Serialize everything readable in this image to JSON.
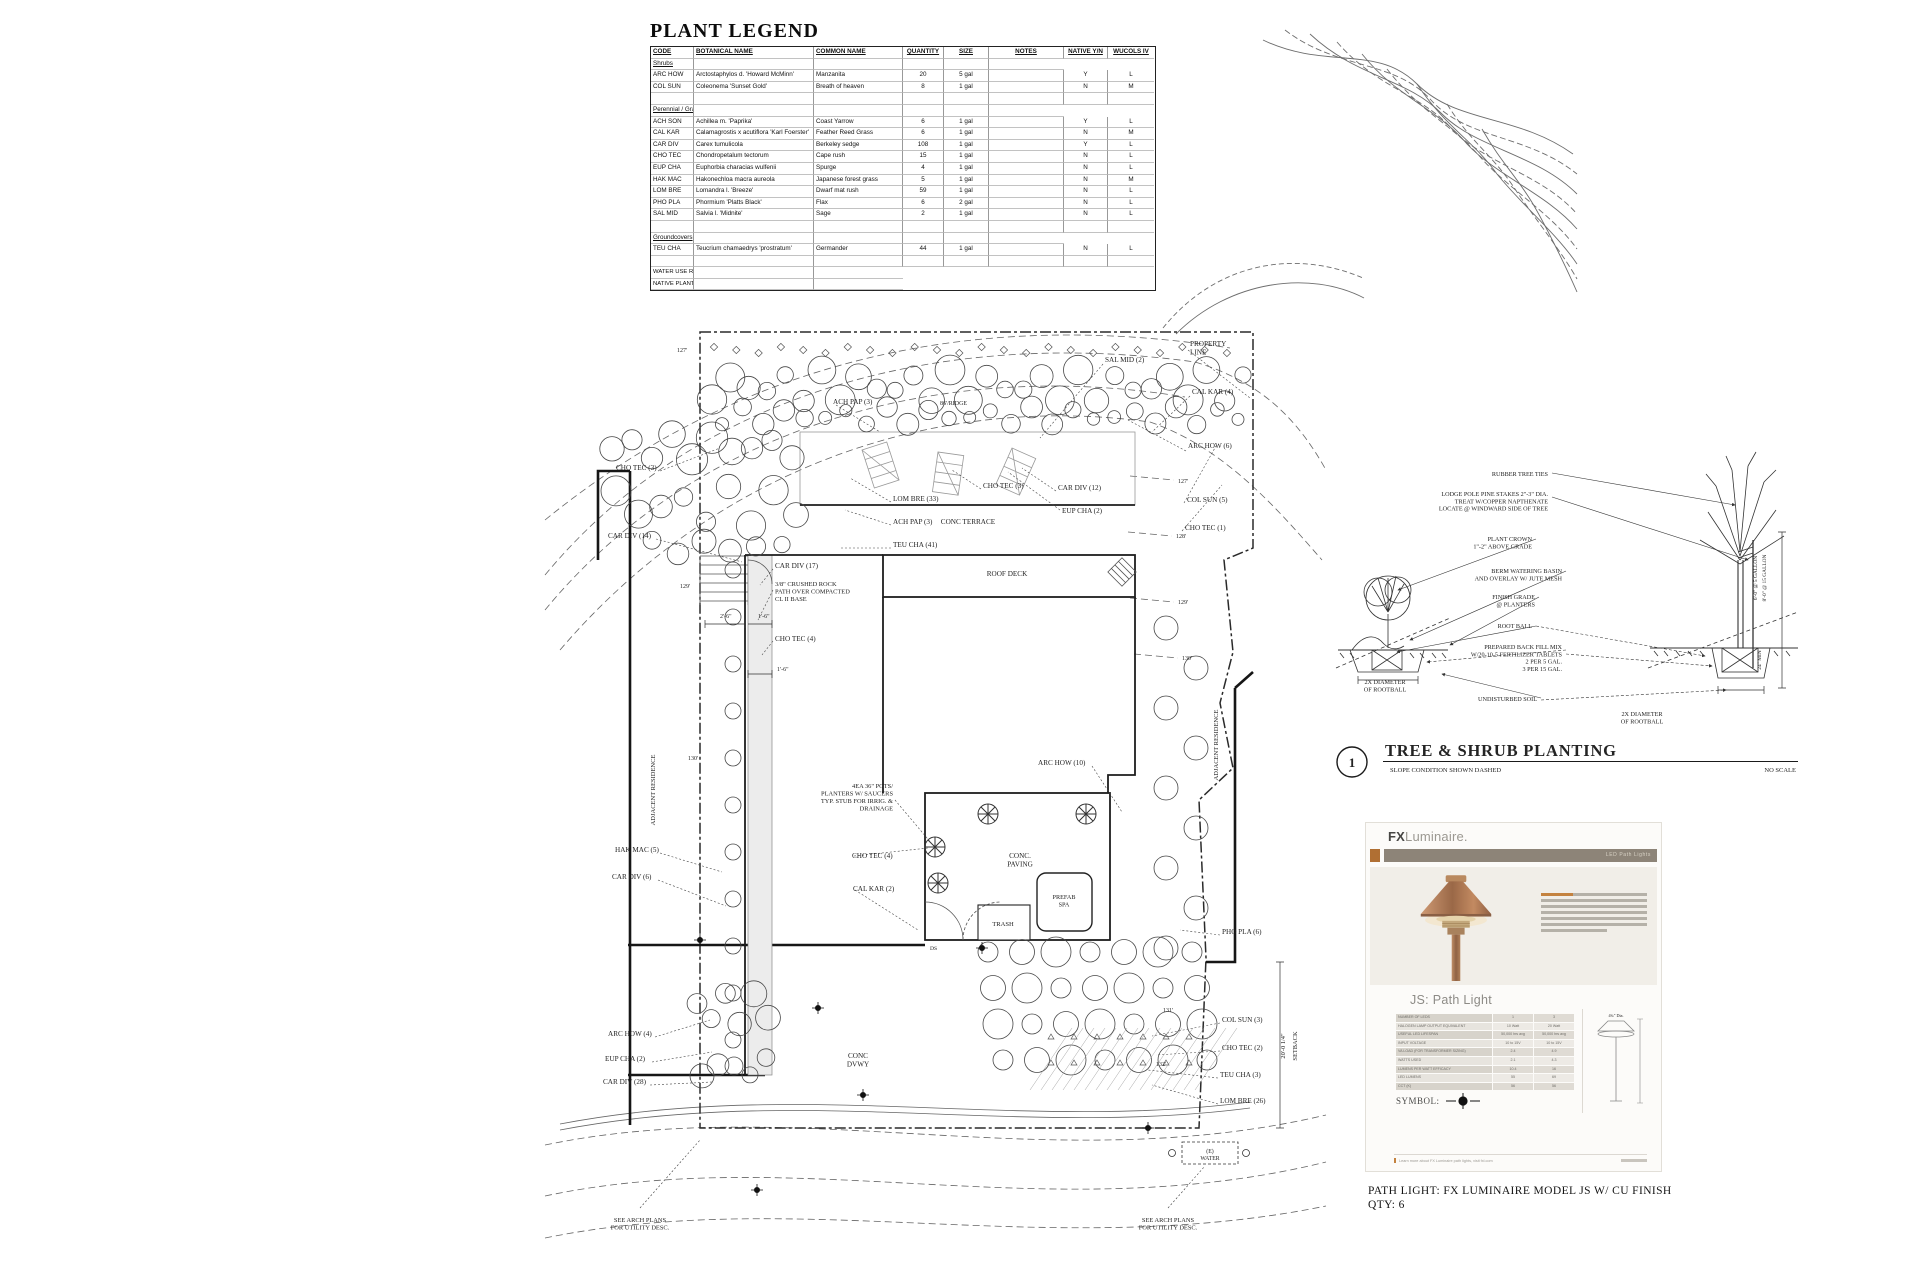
{
  "plant_legend": {
    "title": "PLANT LEGEND",
    "columns": [
      "CODE",
      "BOTANICAL NAME",
      "COMMON NAME",
      "QUANTITY",
      "SIZE",
      "NOTES",
      "NATIVE Y/N",
      "WUCOLS IV"
    ],
    "rows": [
      {
        "type": "section",
        "label": "Shrubs"
      },
      {
        "type": "item",
        "cells": [
          "ARC HOW",
          "Arctostaphylos d. 'Howard McMinn'",
          "Manzanita",
          "20",
          "5 gal",
          "",
          "Y",
          "L"
        ]
      },
      {
        "type": "item",
        "cells": [
          "COL SUN",
          "Coleonema 'Sunset Gold'",
          "Breath of heaven",
          "8",
          "1 gal",
          "",
          "N",
          "M"
        ]
      },
      {
        "type": "blank"
      },
      {
        "type": "section",
        "label": "Perennial / Grasses / Vines"
      },
      {
        "type": "item",
        "cells": [
          "ACH SON",
          "Achillea m. 'Paprika'",
          "Coast Yarrow",
          "6",
          "1 gal",
          "",
          "Y",
          "L"
        ]
      },
      {
        "type": "item",
        "cells": [
          "CAL KAR",
          "Calamagrostis x acutiflora 'Karl Foerster'",
          "Feather Reed Grass",
          "6",
          "1 gal",
          "",
          "N",
          "M"
        ]
      },
      {
        "type": "item",
        "cells": [
          "CAR DIV",
          "Carex tumulicola",
          "Berkeley sedge",
          "108",
          "1 gal",
          "",
          "Y",
          "L"
        ]
      },
      {
        "type": "item",
        "cells": [
          "CHO TEC",
          "Chondropetalum tectorum",
          "Cape rush",
          "15",
          "1 gal",
          "",
          "N",
          "L"
        ]
      },
      {
        "type": "item",
        "cells": [
          "EUP CHA",
          "Euphorbia characias wulfenii",
          "Spurge",
          "4",
          "1 gal",
          "",
          "N",
          "L"
        ]
      },
      {
        "type": "item",
        "cells": [
          "HAK MAC",
          "Hakonechloa macra aureola",
          "Japanese forest grass",
          "5",
          "1 gal",
          "",
          "N",
          "M"
        ]
      },
      {
        "type": "item",
        "cells": [
          "LOM BRE",
          "Lomandra l. 'Breeze'",
          "Dwarf mat rush",
          "59",
          "1 gal",
          "",
          "N",
          "L"
        ]
      },
      {
        "type": "item",
        "cells": [
          "PHO PLA",
          "Phormium 'Platts Black'",
          "Flax",
          "6",
          "2 gal",
          "",
          "N",
          "L"
        ]
      },
      {
        "type": "item",
        "cells": [
          "SAL MID",
          "Salvia l. 'Midnite'",
          "Sage",
          "2",
          "1 gal",
          "",
          "N",
          "L"
        ]
      },
      {
        "type": "blank"
      },
      {
        "type": "section",
        "label": "Groundcovers"
      },
      {
        "type": "item",
        "cells": [
          "TEU CHA",
          "Teucrium chamaedrys 'prostratum'",
          "Germander",
          "44",
          "1 gal",
          "",
          "N",
          "L"
        ]
      },
      {
        "type": "blank"
      }
    ],
    "notes": [
      "WATER USE RATINGS OBTAINED FROM THE \"WATER USE CLASSIFICATION OF LANDSCAPE SPECIES (WUCOLS)\" LIST.",
      "NATIVE PLANTS INFORMATION OBTAINED FROM THE 'STOPWASTE.ORG' LIST OF LOCAL NATIVE PLANTS & CALFLORA.ORG"
    ]
  },
  "site_plan": {
    "labels": [
      {
        "x": 833,
        "y": 404,
        "l": [
          "ACH PAP (3)"
        ]
      },
      {
        "x": 940,
        "y": 405,
        "s": 6,
        "l": [
          "86'/RIDGE"
        ]
      },
      {
        "x": 1105,
        "y": 362,
        "l": [
          "SAL MID (2)"
        ]
      },
      {
        "x": 1190,
        "y": 346,
        "l": [
          "PROPERTY",
          "LINE"
        ]
      },
      {
        "x": 1192,
        "y": 394,
        "l": [
          "CAL KAR (4)"
        ]
      },
      {
        "x": 1188,
        "y": 448,
        "l": [
          "ARC HOW (6)"
        ]
      },
      {
        "x": 1187,
        "y": 502,
        "l": [
          "COL SUN (5)"
        ]
      },
      {
        "x": 1185,
        "y": 530,
        "l": [
          "CHO TEC (1)"
        ]
      },
      {
        "x": 983,
        "y": 488,
        "l": [
          "CHO TEC (3)"
        ]
      },
      {
        "x": 1058,
        "y": 490,
        "l": [
          "CAR DIV (12)"
        ]
      },
      {
        "x": 1062,
        "y": 513,
        "l": [
          "EUP CHA (2)"
        ]
      },
      {
        "x": 893,
        "y": 501,
        "l": [
          "LOM BRE (33)"
        ]
      },
      {
        "x": 968,
        "y": 524,
        "a": "m",
        "l": [
          "CONC TERRACE"
        ]
      },
      {
        "x": 893,
        "y": 524,
        "l": [
          "ACH PAP (3)"
        ]
      },
      {
        "x": 893,
        "y": 547,
        "l": [
          "TEU CHA (41)"
        ]
      },
      {
        "x": 616,
        "y": 470,
        "l": [
          "CHO TEC (3)"
        ]
      },
      {
        "x": 608,
        "y": 538,
        "l": [
          "CAR DIV (14)"
        ]
      },
      {
        "x": 775,
        "y": 568,
        "l": [
          "CAR DIV (17)"
        ]
      },
      {
        "x": 775,
        "y": 586,
        "s": 6.4,
        "l": [
          "3/8\" CRUSHED ROCK",
          "PATH OVER COMPACTED",
          "CL II BASE"
        ]
      },
      {
        "x": 720,
        "y": 618,
        "s": 6,
        "l": [
          "2'-6\""
        ]
      },
      {
        "x": 758,
        "y": 618,
        "s": 6,
        "l": [
          "1'-6\""
        ]
      },
      {
        "x": 775,
        "y": 641,
        "l": [
          "CHO TEC (4)"
        ]
      },
      {
        "x": 777,
        "y": 671,
        "s": 6,
        "l": [
          "1'-6\""
        ]
      },
      {
        "x": 1007,
        "y": 576,
        "a": "m",
        "l": [
          "ROOF DECK"
        ]
      },
      {
        "x": 655,
        "y": 790,
        "r": -90,
        "a": "m",
        "s": 6.5,
        "l": [
          "ADJACENT RESIDENCE"
        ]
      },
      {
        "x": 1218,
        "y": 745,
        "r": -90,
        "a": "m",
        "s": 6.5,
        "l": [
          "ADJACENT RESIDENCE"
        ]
      },
      {
        "x": 677,
        "y": 352,
        "s": 6,
        "l": [
          "127'"
        ]
      },
      {
        "x": 680,
        "y": 588,
        "s": 6,
        "l": [
          "129'"
        ]
      },
      {
        "x": 688,
        "y": 760,
        "s": 6,
        "l": [
          "130'"
        ]
      },
      {
        "x": 1178,
        "y": 483,
        "s": 6,
        "l": [
          "127'"
        ]
      },
      {
        "x": 1176,
        "y": 538,
        "s": 6,
        "l": [
          "128'"
        ]
      },
      {
        "x": 1178,
        "y": 604,
        "s": 6,
        "l": [
          "129'"
        ]
      },
      {
        "x": 1182,
        "y": 660,
        "s": 6,
        "l": [
          "130'"
        ]
      },
      {
        "x": 1163,
        "y": 1012,
        "s": 6,
        "l": [
          "131'"
        ]
      },
      {
        "x": 1156,
        "y": 1066,
        "s": 6,
        "l": [
          "132'"
        ]
      },
      {
        "x": 615,
        "y": 852,
        "l": [
          "HAK MAC (5)"
        ]
      },
      {
        "x": 612,
        "y": 879,
        "l": [
          "CAR DIV (6)"
        ]
      },
      {
        "x": 893,
        "y": 788,
        "a": "e",
        "s": 6.4,
        "l": [
          "4EA 36\" POTS/",
          "PLANTERS W/ SAUCERS",
          "TYP. STUB FOR IRRIG. &",
          "DRAINAGE"
        ]
      },
      {
        "x": 852,
        "y": 858,
        "l": [
          "CHO TEC (4)"
        ]
      },
      {
        "x": 853,
        "y": 891,
        "l": [
          "CAL KAR (2)"
        ]
      },
      {
        "x": 1020,
        "y": 858,
        "a": "m",
        "l": [
          "CONC.",
          "PAVING"
        ]
      },
      {
        "x": 1003,
        "y": 926,
        "a": "m",
        "s": 6.6,
        "l": [
          "TRASH"
        ]
      },
      {
        "x": 1064,
        "y": 899,
        "a": "m",
        "s": 6.2,
        "l": [
          "PREFAB",
          "SPA"
        ]
      },
      {
        "x": 1038,
        "y": 765,
        "l": [
          "ARC HOW (10)"
        ]
      },
      {
        "x": 930,
        "y": 950,
        "s": 5.6,
        "l": [
          "DS"
        ]
      },
      {
        "x": 608,
        "y": 1036,
        "l": [
          "ARC HOW (4)"
        ]
      },
      {
        "x": 605,
        "y": 1061,
        "l": [
          "EUP CHA (2)"
        ]
      },
      {
        "x": 603,
        "y": 1084,
        "l": [
          "CAR DIV (28)"
        ]
      },
      {
        "x": 858,
        "y": 1058,
        "a": "m",
        "l": [
          "CONC",
          "DVWY"
        ]
      },
      {
        "x": 1222,
        "y": 1022,
        "l": [
          "COL SUN (3)"
        ]
      },
      {
        "x": 1222,
        "y": 1050,
        "l": [
          "CHO TEC (2)"
        ]
      },
      {
        "x": 1220,
        "y": 1077,
        "l": [
          "TEU CHA (3)"
        ]
      },
      {
        "x": 1220,
        "y": 1103,
        "l": [
          "LOM BRE (26)"
        ]
      },
      {
        "x": 1222,
        "y": 934,
        "l": [
          "PHO PLA (6)"
        ]
      },
      {
        "x": 1285,
        "y": 1046,
        "r": -90,
        "a": "m",
        "s": 6.4,
        "l": [
          "20'-0 1/4\""
        ]
      },
      {
        "x": 1297,
        "y": 1046,
        "r": -90,
        "a": "m",
        "s": 6.4,
        "l": [
          "SETBACK"
        ]
      },
      {
        "x": 1210,
        "y": 1153,
        "a": "m",
        "s": 5.8,
        "l": [
          "(E)",
          "WATER"
        ]
      },
      {
        "x": 640,
        "y": 1222,
        "a": "m",
        "s": 6.4,
        "l": [
          "SEE ARCH PLANS",
          "FOR UTILITY DESC."
        ]
      },
      {
        "x": 1168,
        "y": 1222,
        "a": "m",
        "s": 6.4,
        "l": [
          "SEE ARCH PLANS",
          "FOR UTILITY DESC."
        ]
      }
    ]
  },
  "planting_detail": {
    "number": "1",
    "title": "TREE & SHRUB PLANTING",
    "subtitle": "SLOPE CONDITION SHOWN DASHED",
    "scale": "NO SCALE",
    "callouts": [
      {
        "x": 1548,
        "y": 476,
        "a": "e",
        "l": [
          "RUBBER TREE TIES"
        ]
      },
      {
        "x": 1548,
        "y": 496,
        "a": "e",
        "l": [
          "LODGE POLE PINE STAKES 2\"-3\" DIA.",
          "TREAT W/COPPER NAPTHENATE",
          "LOCATE @ WINDWARD SIDE OF TREE"
        ]
      },
      {
        "x": 1532,
        "y": 541,
        "a": "e",
        "l": [
          "PLANT CROWN",
          "1\"-2\" ABOVE GRADE"
        ]
      },
      {
        "x": 1562,
        "y": 573,
        "a": "e",
        "l": [
          "BERM WATERING BASIN",
          "AND OVERLAY W/ JUTE MESH"
        ]
      },
      {
        "x": 1535,
        "y": 599,
        "a": "e",
        "l": [
          "FINISH GRADE",
          "@ PLANTERS"
        ]
      },
      {
        "x": 1532,
        "y": 628,
        "a": "e",
        "l": [
          "ROOT BALL"
        ]
      },
      {
        "x": 1562,
        "y": 649,
        "a": "e",
        "l": [
          "PREPARED BACK FILL MIX",
          "W/20-10-5 FERTILIZER TABLETS",
          "2 PER 5 GAL.",
          "3 PER 15 GAL."
        ]
      },
      {
        "x": 1385,
        "y": 684,
        "a": "m",
        "l": [
          "2X DIAMETER",
          "OF ROOTBALL"
        ]
      },
      {
        "x": 1537,
        "y": 701,
        "a": "e",
        "l": [
          "UNDISTURBED SOIL"
        ]
      },
      {
        "x": 1642,
        "y": 716,
        "a": "m",
        "l": [
          "2X DIAMETER",
          "OF ROOTBALL"
        ]
      },
      {
        "x": 1757,
        "y": 578,
        "r": -90,
        "a": "m",
        "s": 5.4,
        "l": [
          "6'-0\" @ 5 GALLON"
        ]
      },
      {
        "x": 1766,
        "y": 578,
        "r": -90,
        "a": "m",
        "s": 5.4,
        "l": [
          "8'-0\" @ 15 GALLON"
        ]
      },
      {
        "x": 1761,
        "y": 660,
        "r": -90,
        "a": "m",
        "s": 5.4,
        "l": [
          "24\" MIN"
        ]
      }
    ]
  },
  "cutsheet": {
    "brand_bold": "FX",
    "brand_rest": "Luminaire.",
    "banner": "LED Path Lights",
    "product": "JS: Path Light",
    "spec": [
      {
        "label": "NUMBER OF LEDS",
        "v1": "1",
        "v2": "3"
      },
      {
        "label": "HALOGEN LAMP OUTPUT EQUIVALENT",
        "v1": "10 Watt",
        "v2": "20 Watt"
      },
      {
        "label": "USEFUL LED LIFESPAN",
        "v1": "50,000 hrs avg",
        "v2": "50,000 hrs avg"
      },
      {
        "label": "INPUT VOLTAGE",
        "v1": "10 to 15V",
        "v2": "10 to 15V"
      },
      {
        "label": "VA LOAD (FOR TRANSFORMER SIZING)",
        "v1": "2.4",
        "v2": "4.9"
      },
      {
        "label": "WATTS USED",
        "v1": "2.1",
        "v2": "4.3"
      },
      {
        "label": "LUMENS PER WATT EFFICACY",
        "v1": "10.4",
        "v2": "16"
      },
      {
        "label": "LED LUMENS",
        "v1": "55",
        "v2": "69"
      },
      {
        "label": "CCT (K)",
        "v1": "56",
        "v2": "56"
      }
    ],
    "dim_label": "4¾\" Dia.",
    "symbol_label": "SYMBOL:",
    "footer": "Learn more about FX Luminaire path lights, visit fxl.com",
    "caption_line1": "PATH LIGHT: FX LUMINAIRE MODEL JS W/ CU FINISH",
    "caption_line2": "QTY: 6"
  }
}
